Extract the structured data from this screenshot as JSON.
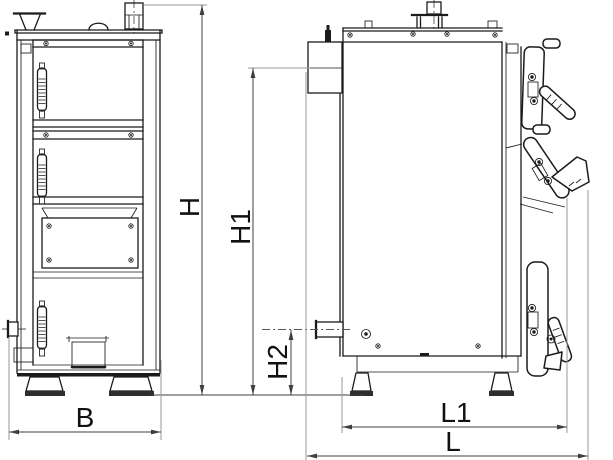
{
  "diagram": {
    "dimension_labels": {
      "h": "H",
      "h1": "H1",
      "h2": "H2",
      "b": "B",
      "l1": "L1",
      "l": "L"
    },
    "colors": {
      "outline": "#1b1b1b",
      "dimension": "#3f3f3f",
      "extension": "#9a9a9a",
      "background": "#ffffff"
    }
  }
}
